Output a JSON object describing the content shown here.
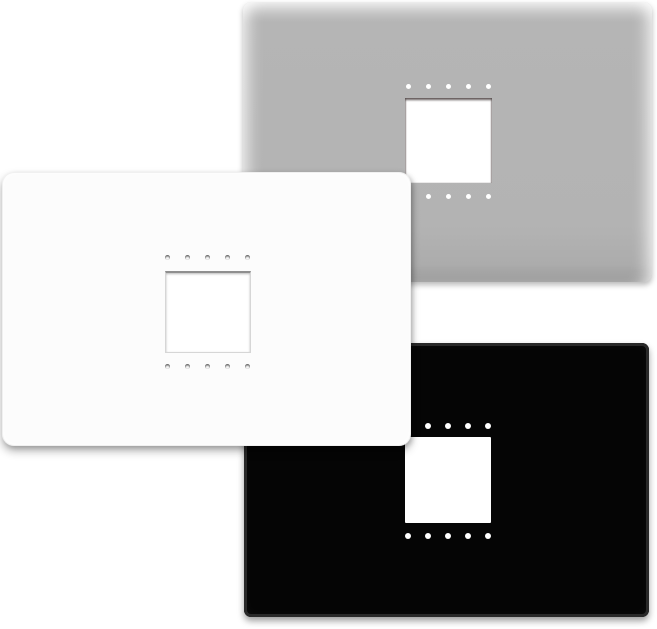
{
  "scene": {
    "width": 657,
    "height": 629,
    "background_color": "#ffffff",
    "description": "Three rectangular wall faceplates, each with a central square module cutout and two horizontal rows of five small mounting holes"
  },
  "plates": [
    {
      "finish": "gray",
      "label": "gray wall plate",
      "body_color": "#b3b3b3",
      "x": 243,
      "y": 2,
      "width": 409,
      "height": 280,
      "z": 1,
      "radius": 8,
      "cutout": {
        "x": 162,
        "y": 96,
        "width": 87,
        "height": 85,
        "fill": "#ffffff"
      },
      "holes": {
        "count_per_row": 5,
        "spacing": 20,
        "size": 5,
        "color": "#ffffff",
        "style": "flat",
        "center_x": 205,
        "top_row_y": 84,
        "bottom_row_y": 194
      }
    },
    {
      "finish": "black",
      "label": "black wall plate",
      "body_color": "#050505",
      "rim_color": "#292929",
      "x": 244,
      "y": 343,
      "width": 405,
      "height": 274,
      "z": 2,
      "radius": 7,
      "cutout": {
        "x": 161,
        "y": 94,
        "width": 86,
        "height": 86,
        "fill": "#ffffff"
      },
      "holes": {
        "count_per_row": 5,
        "spacing": 20,
        "size": 6,
        "color": "#ffffff",
        "style": "flat",
        "center_x": 204,
        "top_row_y": 83,
        "bottom_row_y": 193
      }
    },
    {
      "finish": "white",
      "label": "white wall plate",
      "body_color": "#fcfcfc",
      "x": 2,
      "y": 172,
      "width": 409,
      "height": 274,
      "z": 3,
      "radius": 12,
      "cutout": {
        "x": 163,
        "y": 99,
        "width": 86,
        "height": 82,
        "fill": "#ffffff"
      },
      "holes": {
        "count_per_row": 5,
        "spacing": 20,
        "size": 5,
        "color": "#f6f6f6",
        "style": "recessed",
        "center_x": 205,
        "top_row_y": 85,
        "bottom_row_y": 194
      }
    }
  ]
}
